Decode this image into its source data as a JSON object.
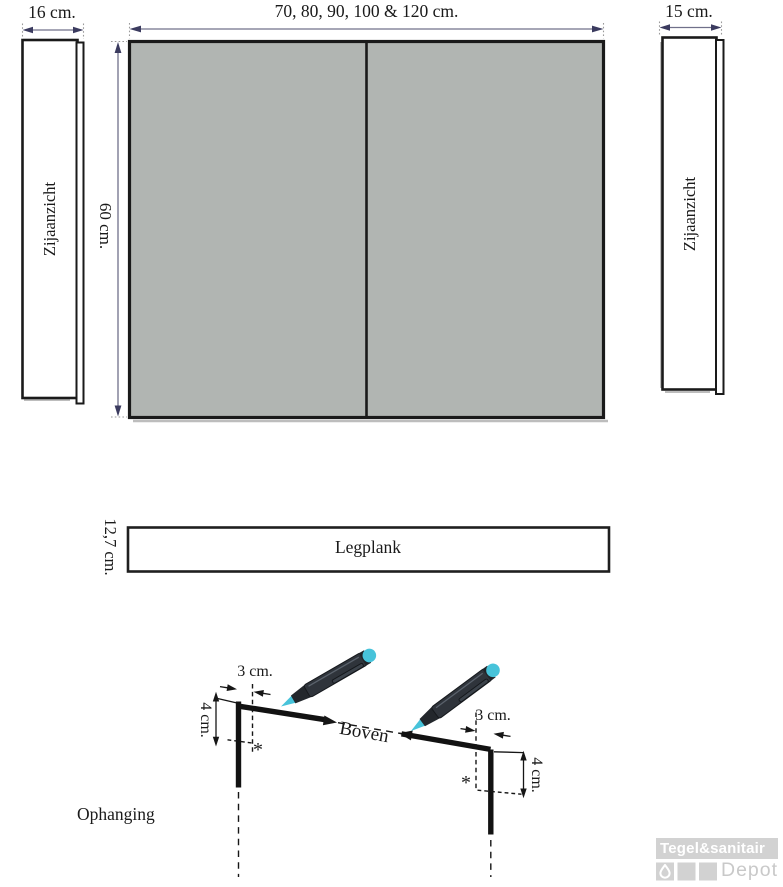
{
  "front_view": {
    "width_label": "70, 80, 90, 100 & 120 cm.",
    "height_label": "60 cm."
  },
  "side_view_left": {
    "depth_label": "16 cm.",
    "name": "Zijaanzicht"
  },
  "side_view_right": {
    "depth_label": "15 cm.",
    "name": "Zijaanzicht"
  },
  "shelf": {
    "depth_label": "12,7 cm.",
    "name": "Legplank"
  },
  "hanging": {
    "section_label": "Ophanging",
    "top_label": "Boven",
    "left": {
      "offset_label": "3 cm.",
      "height_label": "4 cm.",
      "mark": "*"
    },
    "right": {
      "offset_label": "3 cm.",
      "height_label": "4 cm.",
      "mark": "*"
    }
  },
  "logo": {
    "brand": "Tegel&sanitair",
    "sub_brand": "Depot",
    "icon": "water-drop-icon"
  },
  "colors": {
    "cabinet_fill": "#b1b5b2",
    "outline": "#1a1a1a",
    "dim_line": "#70708a",
    "dim_arrow": "#3b3b5f",
    "drawing_black": "#161616",
    "pen_body": "#2f343b",
    "pen_accent": "#47c3da",
    "logo_gray": "#d2d2d2"
  }
}
